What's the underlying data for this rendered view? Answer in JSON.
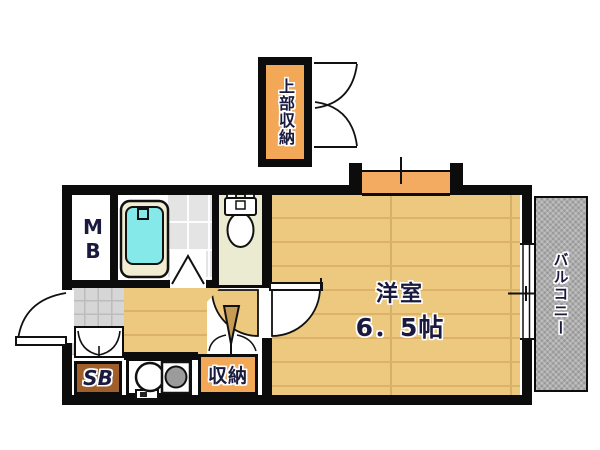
{
  "plan": {
    "type": "apartment-floor-plan",
    "labels": {
      "upper_storage": "上部収納",
      "meter_box": "MB",
      "room_name": "洋室",
      "room_size": "6．5帖",
      "balcony": "バルコニー",
      "shoe_box": "SB",
      "storage": "収納"
    },
    "fixtures": {
      "bathtub": "bathtub",
      "toilet": "toilet",
      "kitchen_sink": "round-sink",
      "stove": "single-burner-stove"
    },
    "colors": {
      "wall": "#0c0c0c",
      "wood_floor": "#ecc97e",
      "accent_orange": "#f2a857",
      "shoe_box_brown": "#a05e2a",
      "tub_cyan": "#85e9e9",
      "tub_rim": "#f1ecd2",
      "toilet_floor": "#ebebd2",
      "tile_gray": "#e4e4e4",
      "genkan_gray": "#d6d6d6",
      "balcony_gray": "#adadad",
      "label_navy": "#1a1a3e"
    }
  }
}
